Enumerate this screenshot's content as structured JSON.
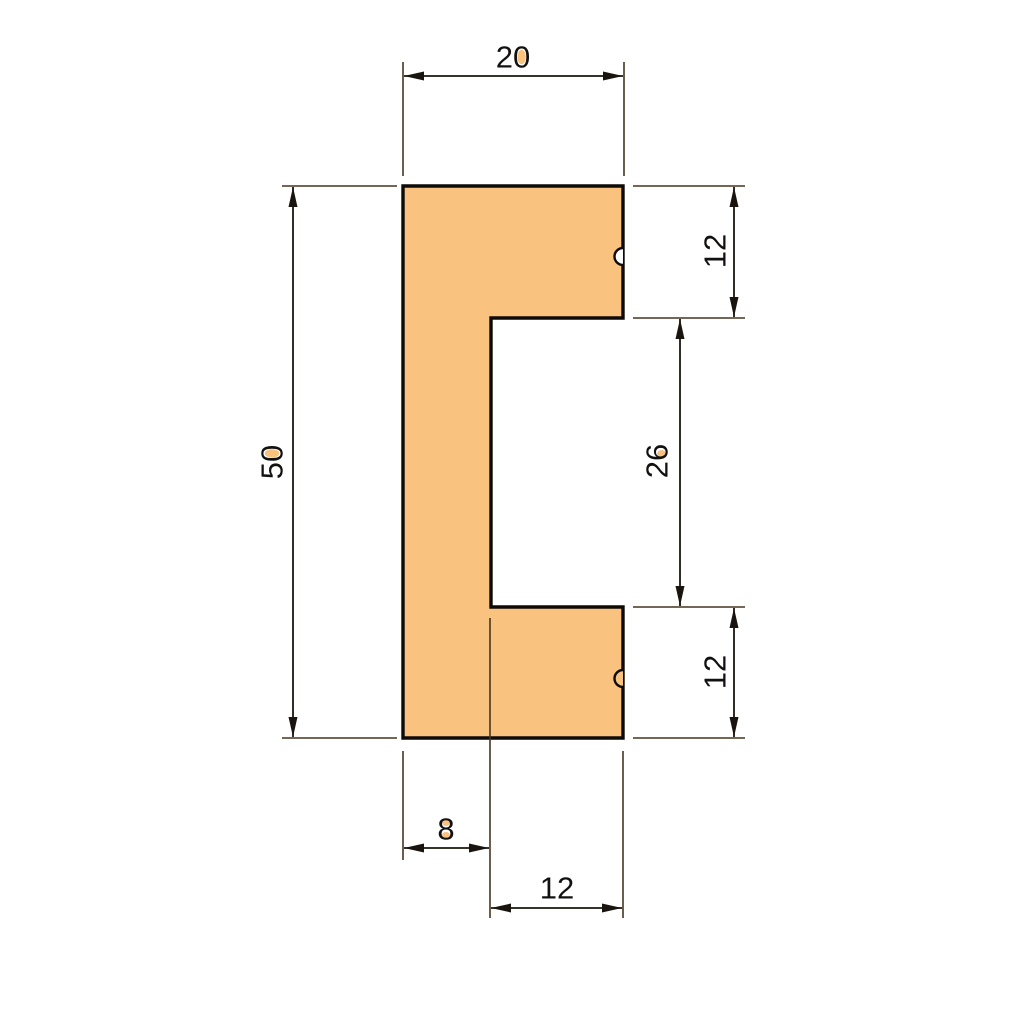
{
  "drawing_type": "dimensioned-profile-cross-section",
  "colors": {
    "bg": "#ffffff",
    "fill": "#F9C27E",
    "outline": "#0d0a07",
    "dim": "#1a140e",
    "ext": "#46351f",
    "text": "#131110"
  },
  "dimensions": {
    "top_width": {
      "label": "20",
      "value": 20,
      "orientation": "horizontal",
      "position": "top"
    },
    "left_height": {
      "label": "50",
      "value": 50,
      "orientation": "vertical",
      "position": "left"
    },
    "right_flange_top": {
      "label": "12",
      "value": 12,
      "orientation": "vertical",
      "position": "right-top"
    },
    "right_slot_height": {
      "label": "26",
      "value": 26,
      "orientation": "vertical",
      "position": "right-middle"
    },
    "right_flange_bottom": {
      "label": "12",
      "value": 12,
      "orientation": "vertical",
      "position": "right-bottom"
    },
    "bottom_web": {
      "label": "8",
      "value": 8,
      "orientation": "horizontal",
      "position": "bottom-left"
    },
    "bottom_slot_width": {
      "label": "12",
      "value": 12,
      "orientation": "horizontal",
      "position": "bottom-right"
    }
  }
}
